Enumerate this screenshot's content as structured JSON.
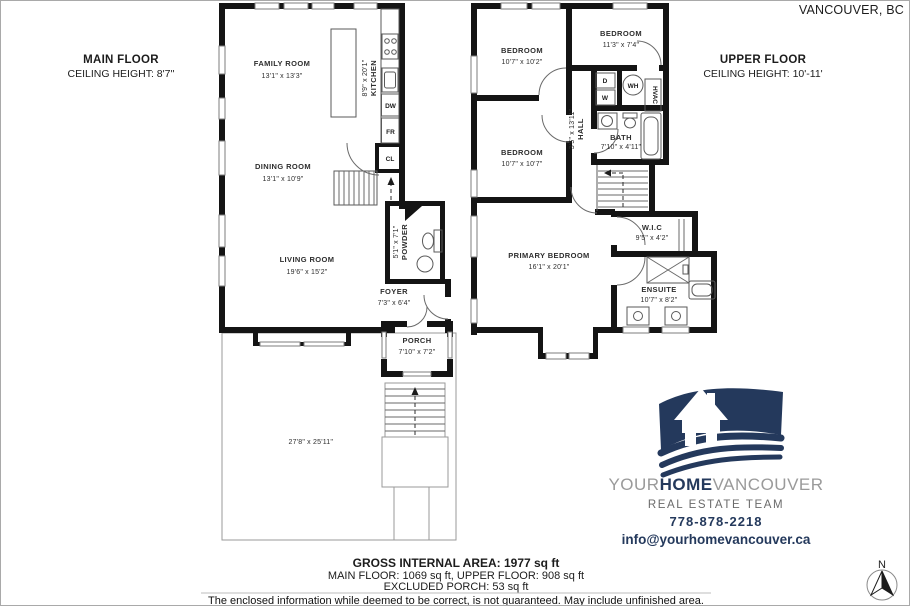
{
  "location": "VANCOUVER, BC",
  "main_floor": {
    "title": "MAIN FLOOR",
    "ceiling": "CEILING HEIGHT: 8'7''",
    "family_room": {
      "name": "FAMILY ROOM",
      "dims": "13'1\" x 13'3\""
    },
    "kitchen": {
      "name": "KITCHEN",
      "dims": "8'9\" x 20'1\""
    },
    "dining_room": {
      "name": "DINING ROOM",
      "dims": "13'1\" x 10'9\""
    },
    "living_room": {
      "name": "LIVING ROOM",
      "dims": "19'6\" x 15'2\""
    },
    "powder": {
      "name": "POWDER",
      "dims": "5'1\" x 7'1\""
    },
    "foyer": {
      "name": "FOYER",
      "dims": "7'3\" x 6'4\""
    },
    "porch": {
      "name": "PORCH",
      "dims": "7'10\" x 7'2\""
    },
    "yard_dims": "27'8\" x 25'11''",
    "fixtures": {
      "fr": "FR",
      "dw": "DW",
      "cl": "CL"
    }
  },
  "upper_floor": {
    "title": "UPPER FLOOR",
    "ceiling": "CEILING HEIGHT: 10'-11'",
    "bedroom1": {
      "name": "BEDROOM",
      "dims": "10'7\" x 10'2\""
    },
    "bedroom2": {
      "name": "BEDROOM",
      "dims": "11'3\" x 7'4\""
    },
    "bedroom3": {
      "name": "BEDROOM",
      "dims": "10'7\" x 10'7\""
    },
    "primary_bedroom": {
      "name": "PRIMARY BEDROOM",
      "dims": "16'1\" x 20'1\""
    },
    "hall": {
      "name": "HALL",
      "dims": "3'5\" x 13'11\""
    },
    "bath": {
      "name": "BATH",
      "dims": "7'10\" x 4'11\""
    },
    "wic": {
      "name": "W.I.C",
      "dims": "9'5\" x 4'2\""
    },
    "ensuite": {
      "name": "ENSUITE",
      "dims": "10'7\" x 8'2\""
    },
    "fixtures": {
      "d": "D",
      "w": "W",
      "wh": "WH",
      "hvac": "HVAC"
    }
  },
  "branding": {
    "name_gray1": "YOUR",
    "name_bold": "HOME",
    "name_gray2": "VANCOUVER",
    "tagline": "REAL ESTATE TEAM",
    "phone": "778-878-2218",
    "email": "info@yourhomevancouver.ca",
    "brand_navy": "#24395c",
    "brand_gray": "#9a9a9a"
  },
  "summary": {
    "gross": "GROSS INTERNAL AREA: 1977 sq ft",
    "floors": "MAIN FLOOR: 1069 sq ft, UPPER FLOOR: 908 sq ft",
    "excluded": "EXCLUDED PORCH: 53 sq ft"
  },
  "disclaimer": "The enclosed information while deemed to be correct, is not guaranteed. May include unfinished area.",
  "compass_n": "N"
}
